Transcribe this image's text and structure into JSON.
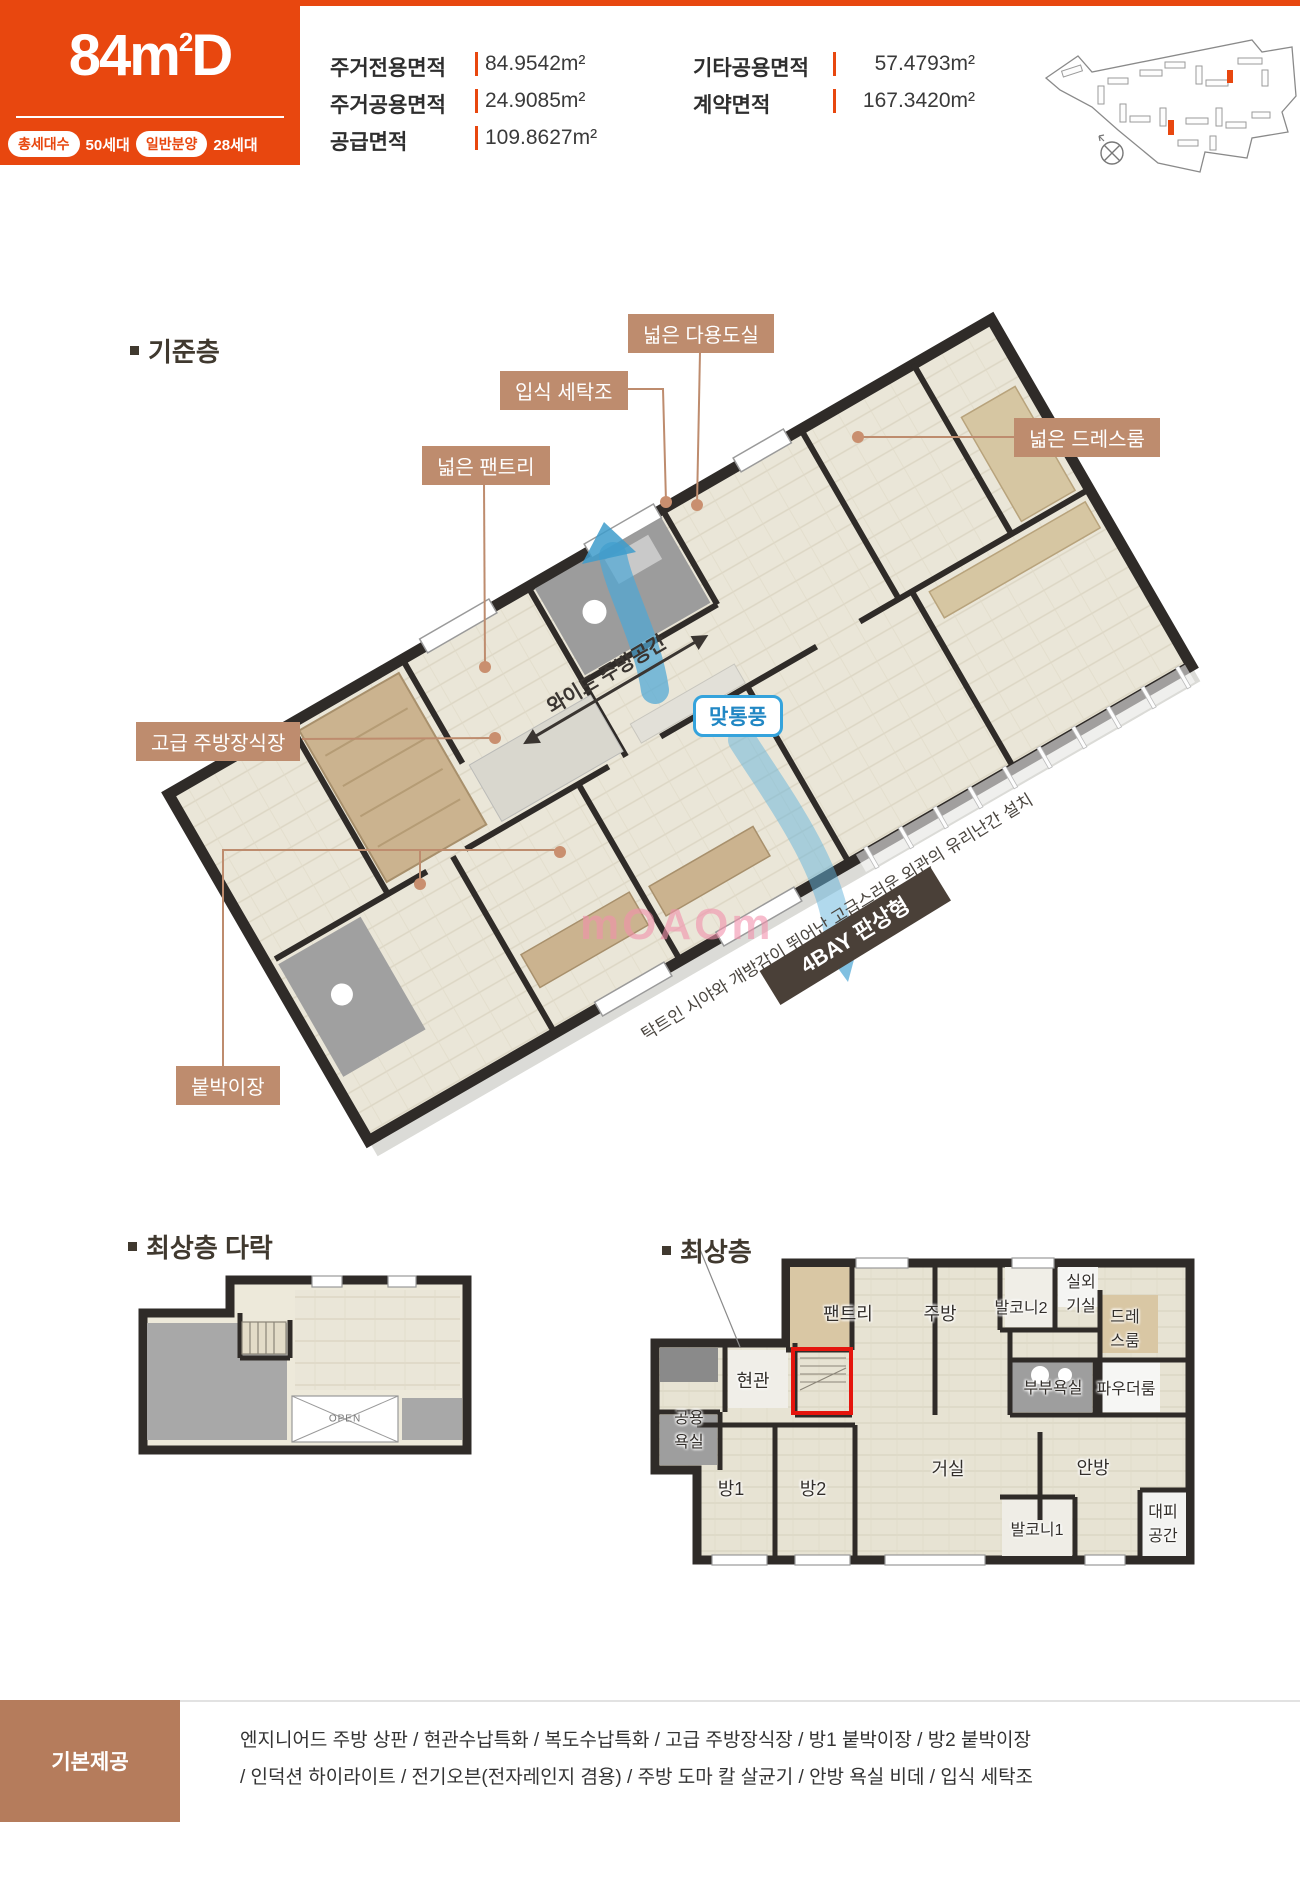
{
  "hero": {
    "type_prefix": "84m",
    "type_sup": "2",
    "type_suffix": "D",
    "badge1_label": "총세대수",
    "badge1_value": "50세대",
    "badge2_label": "일반분양",
    "badge2_value": "28세대"
  },
  "areas": {
    "r1c1_label": "주거전용면적",
    "r1c1_value": "84.9542m²",
    "r1c2_label": "기타공용면적",
    "r1c2_value": "57.4793m²",
    "r2c1_label": "주거공용면적",
    "r2c1_value": "24.9085m²",
    "r2c2_label": "계약면적",
    "r2c2_value": "167.3420m²",
    "r3c1_label": "공급면적",
    "r3c1_value": "109.8627m²"
  },
  "sections": {
    "base_floor": "기준층",
    "attic": "최상층 다락",
    "top_floor": "최상층"
  },
  "callouts": {
    "utility": "넓은 다용도실",
    "washer": "입식 세탁조",
    "pantry": "넓은 팬트리",
    "dressroom": "넓은 드레스룸",
    "kitchen_cabinet": "고급 주방장식장",
    "closet": "붙박이장"
  },
  "plan3d": {
    "airflow_badge": "맞통풍",
    "kitchen_span": "와이드 주방공간",
    "bay_badge": "4BAY 판상형",
    "caption": "탁트인 시야와 개방감이 뛰어난 고급스러운 외관의 유리난간 설치",
    "watermark": "mOAOm"
  },
  "attic_plan": {
    "open_label": "OPEN"
  },
  "top_plan": {
    "pantry": "팬트리",
    "kitchen": "주방",
    "balcony2": "발코니2",
    "ac_room": "실외\n기실",
    "dressroom": "드레\n스룸",
    "entrance": "현관",
    "shared_bath": "공용\n욕실",
    "master_bath": "부부욕실",
    "powder": "파우더룸",
    "master": "안방",
    "room1": "방1",
    "room2": "방2",
    "living": "거실",
    "balcony1": "발코니1",
    "shelter": "대피\n공간"
  },
  "provision": {
    "title": "기본제공",
    "line1": "엔지니어드 주방 상판 / 현관수납특화 / 복도수납특화 / 고급 주방장식장 / 방1 붙박이장 / 방2 붙박이장",
    "line2": "/ 인덕션 하이라이트 / 전기오븐(전자레인지 겸용) / 주방 도마 칼 살균기 / 안방 욕실 비데 / 입식 세탁조"
  },
  "colors": {
    "accent_orange": "#E8470F",
    "callout_tan": "#BE8C6E",
    "provision_brown": "#B57C5C",
    "airflow_blue": "#35A3DC",
    "highlight_red": "#E5150D"
  }
}
